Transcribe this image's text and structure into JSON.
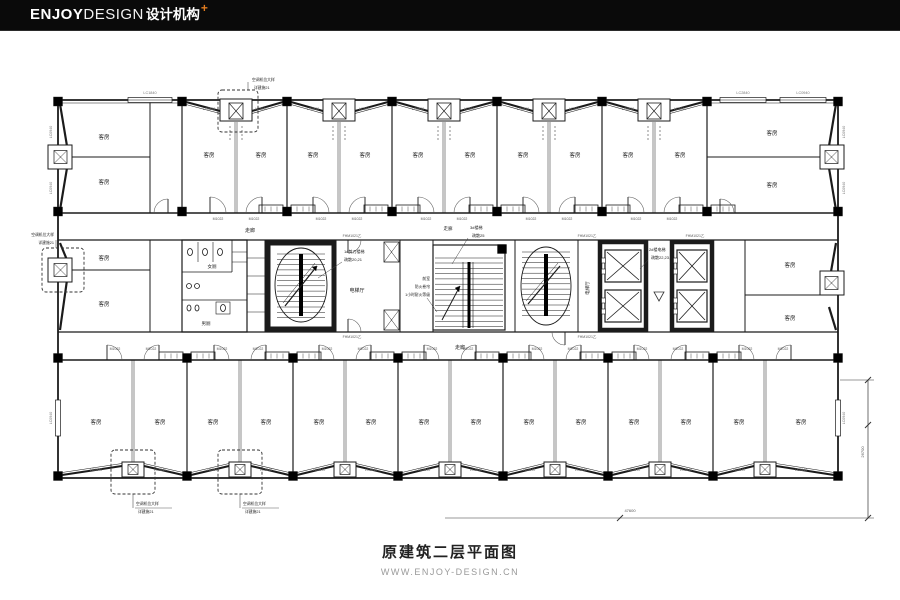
{
  "header": {
    "logo_part1": "ENJOY",
    "logo_part2": "DESIGN",
    "logo_part3": "设计机构",
    "logo_plus": "+",
    "bar_color": "#0a0a0a",
    "accent_color": "#e07b1f"
  },
  "footer": {
    "title": "原建筑二层平面图",
    "url": "WWW.ENJOY-DESIGN.CN"
  },
  "plan": {
    "labels": {
      "room": "客房",
      "corridor": "走廊",
      "elevator_hall": "电梯厅",
      "wc_women": "女厕",
      "wc_men": "男厕",
      "stair1_line1": "1#剪刀楼梯",
      "stair1_line2": "疏散20,21",
      "stair3_line1": "3#楼梯",
      "stair3_line2": "疏散25",
      "elev_line1": "2#楼电梯",
      "elev_line2": "疏散22,23,24",
      "shutter_line1": "前室",
      "shutter_line2": "防火卷帘",
      "shutter_line3": "1小时耐火等级",
      "ac_line1": "空调机位大样",
      "ac_line2": "详建施21",
      "door_code": "M1022",
      "fire_door_code": "FHM1021乙",
      "win_a": "LC2840",
      "win_b": "LC1840",
      "win_c": "LC0940",
      "dim_v": "26700",
      "dim_h": "47600"
    }
  }
}
